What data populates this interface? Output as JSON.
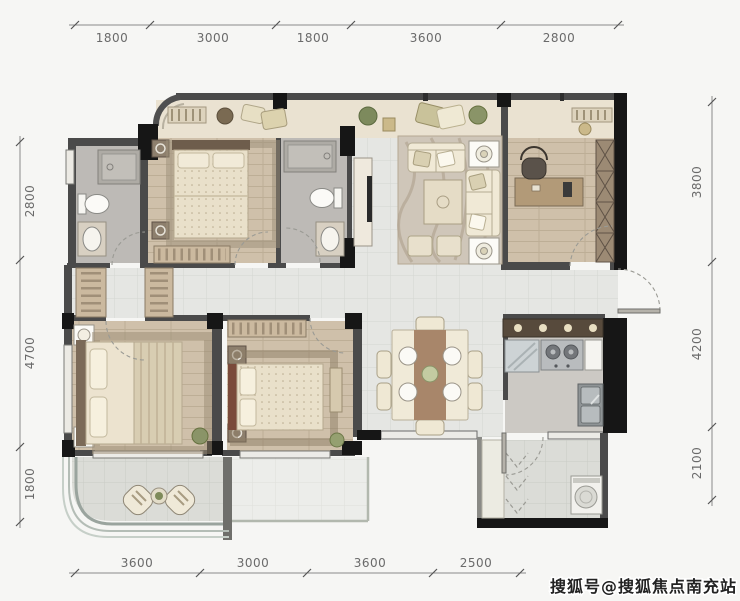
{
  "plan": {
    "watermark": "搜狐号@搜狐焦点南充站",
    "type": "apartment-floor-plan"
  },
  "dims": {
    "top": [
      "1800",
      "3000",
      "1800",
      "3600",
      "2800"
    ],
    "left": [
      "2800",
      "4700",
      "1800"
    ],
    "right": [
      "3800",
      "4200",
      "2100"
    ],
    "bottom": [
      "3600",
      "3000",
      "3600",
      "2500"
    ]
  },
  "colors": {
    "background": "#f6f6f4",
    "wall": "#4a4a4a",
    "wall_black": "#161616",
    "tile_floor": "#e5e6e3",
    "balcony_floor": "#dbdcd7",
    "wood_floor": "#cfc0aa",
    "bath_floor": "#bdbab6",
    "bay_band": "#eae2d1",
    "kitchen_floor": "#ccc9c4",
    "dim_line": "#888888",
    "dim_text": "#6a6a6a",
    "watermark_fill": "#222222"
  }
}
